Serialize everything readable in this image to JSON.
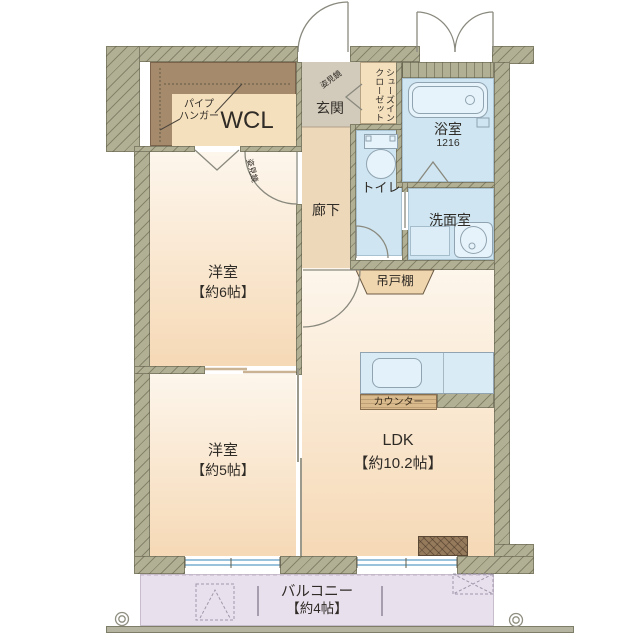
{
  "colors": {
    "wall": "#b1b094",
    "water": "#cfe6f2",
    "room-warm": "#f6d9b6",
    "hall": "#eed8ba",
    "genkan": "#d2cbbc",
    "closet-brown": "#a58a6c",
    "closet-tan": "#f5e0bd",
    "wood": "#d9bb8e",
    "balcony": "#e9e0ed",
    "fixture": "#e7f3fa",
    "cupboard": "#f0d6ae"
  },
  "rooms": {
    "wcl": {
      "label": "WCL",
      "note": "パイプ\nハンガー"
    },
    "genkan": {
      "label": "玄関",
      "mirror": "姿見鏡"
    },
    "shoes_closet": {
      "label": "シューズインクローゼット"
    },
    "bathroom": {
      "label": "浴室",
      "size": "1216"
    },
    "toilet": {
      "label": "トイレ"
    },
    "hallway": {
      "label": "廊下"
    },
    "washroom": {
      "label": "洗面室"
    },
    "bedroom6": {
      "label": "洋室",
      "size": "【約6帖】",
      "mirror": "姿見鏡"
    },
    "bedroom5": {
      "label": "洋室",
      "size": "【約5帖】"
    },
    "ldk": {
      "label": "LDK",
      "size": "【約10.2帖】"
    },
    "balcony": {
      "label": "バルコニー",
      "size": "【約4帖】"
    }
  },
  "fixtures": {
    "hanging_cupboard": "吊戸棚",
    "counter": "カウンター"
  }
}
